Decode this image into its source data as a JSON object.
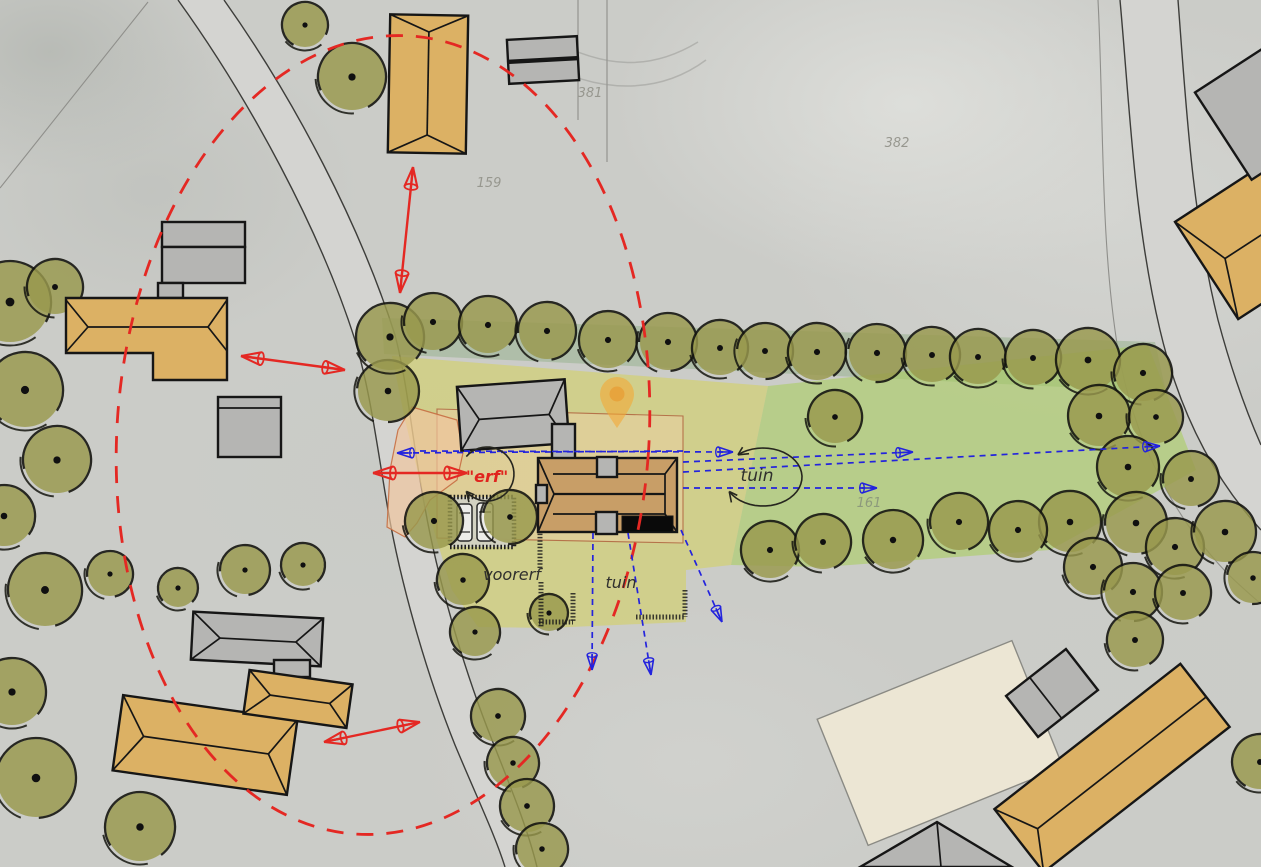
{
  "canvas": {
    "w": 1261,
    "h": 867
  },
  "colors": {
    "tan": "#dcb164",
    "gray": "#b5b5b3",
    "house": "#c89e67",
    "cream": "#ece6d4",
    "black": "#0a0a0a",
    "outline": "#161616",
    "red": "#e42823",
    "blue": "#2323dd",
    "sketch": "#26261f",
    "road_fill": "#d4d4d1",
    "road_edge": "#3d3d3a",
    "tree_fill": "#99994d",
    "tree_line": "#15150f",
    "strip": "rgba(148,176,138,0.5)",
    "green": "rgba(168,206,88,0.55)",
    "yellow": "rgba(213,210,80,0.5)",
    "plot_fill": "rgba(240,206,166,0.45)",
    "plot_edge": "#b5734a",
    "erf_fill": "rgba(240,198,158,0.68)",
    "erf_edge": "rgba(198,110,66,0.9)",
    "pin": "rgba(244,168,54,0.6)",
    "parcel_text": "#97978f"
  },
  "roads": [
    {
      "name": "road-west",
      "band": "M178,0 C250,100 320,230 355,340 C370,390 376,440 388,510 C400,580 425,670 455,745 C478,800 495,835 505,867 L537,867 C528,830 513,793 492,740 C462,665 437,575 425,508 C412,440 408,385 395,335 C360,225 295,100 224,0 Z",
      "edges": [
        "M178,0 C250,100 320,230 355,340 C370,390 376,440 388,510 C400,580 425,670 455,745 C478,800 495,835 505,867",
        "M224,0 C295,100 360,225 395,335 C408,385 412,440 425,508 C437,575 462,665 492,740 C513,793 528,830 537,867"
      ]
    },
    {
      "name": "road-east",
      "band": "M1120,0 C1130,110 1134,220 1160,330 C1180,415 1215,480 1261,530 L1261,445 C1250,420 1234,380 1218,320 C1192,215 1186,105 1178,0 Z",
      "edges": [
        "M1120,0 C1130,110 1134,220 1160,330 C1180,415 1215,480 1261,530",
        "M1178,0 C1186,105 1192,215 1218,320 C1234,380 1250,420 1261,445"
      ]
    }
  ],
  "thin_lines": [
    "M578,0 L578,120",
    "M607,0 L607,162",
    "M148,2 L0,188",
    "M1098,0 C1104,120 1100,240 1118,350 C1134,440 1172,515 1226,572 C1240,586 1252,596 1261,604"
  ],
  "photo_lines": [
    "M535,58 C598,96 660,94 706,60",
    "M548,38 C606,70 652,70 698,42"
  ],
  "zones": [
    {
      "name": "zone-hedge-strip",
      "d": "M382,318 L1155,342 L1166,392 L384,354 Z",
      "fill": "strip"
    },
    {
      "name": "zone-garden-green",
      "d": "M768,386 L1148,345 L1196,470 L1050,550 L823,567 L731,565 Z",
      "fill": "green"
    },
    {
      "name": "zone-yard-yellow",
      "d": "M392,356 L768,386 L731,565 L686,570 L686,622 L548,628 L478,627 L452,590 L424,498 L405,420 Z",
      "fill": "yellow"
    },
    {
      "name": "zone-plot-outline",
      "d": "M437,409 L683,416 L683,543 L437,538 Z",
      "fill": "plot_fill",
      "stroke": "plot_edge",
      "sw": 1.1
    },
    {
      "name": "zone-erf-salmon",
      "d": "M412,407 L457,420 L463,453 L457,480 L430,500 L417,523 L405,537 L387,527 L390,470 L398,430 Z",
      "fill": "erf_fill",
      "stroke": "erf_edge",
      "sw": 1.2
    }
  ],
  "ellipse": {
    "cx": 383,
    "cy": 435,
    "rx": 266,
    "ry": 400,
    "rot": 4,
    "dash": "17 13",
    "sw": 2.8
  },
  "trees": [
    [
      305,
      25,
      22
    ],
    [
      352,
      77,
      33
    ],
    [
      10,
      302,
      40
    ],
    [
      55,
      287,
      27
    ],
    [
      25,
      390,
      37
    ],
    [
      57,
      460,
      33
    ],
    [
      4,
      516,
      30
    ],
    [
      45,
      590,
      36
    ],
    [
      12,
      692,
      33
    ],
    [
      110,
      574,
      22
    ],
    [
      178,
      588,
      19
    ],
    [
      245,
      570,
      24
    ],
    [
      303,
      565,
      21
    ],
    [
      36,
      778,
      39
    ],
    [
      140,
      827,
      34
    ],
    [
      388,
      391,
      30
    ],
    [
      434,
      521,
      28
    ],
    [
      510,
      517,
      26
    ],
    [
      463,
      580,
      25
    ],
    [
      475,
      632,
      24
    ],
    [
      549,
      613,
      18
    ],
    [
      498,
      716,
      26
    ],
    [
      513,
      763,
      25
    ],
    [
      527,
      806,
      26
    ],
    [
      542,
      849,
      25
    ],
    [
      390,
      337,
      33
    ],
    [
      433,
      322,
      28
    ],
    [
      488,
      325,
      28
    ],
    [
      547,
      331,
      28
    ],
    [
      608,
      340,
      28
    ],
    [
      668,
      342,
      28
    ],
    [
      720,
      348,
      27
    ],
    [
      765,
      351,
      27
    ],
    [
      817,
      352,
      28
    ],
    [
      877,
      353,
      28
    ],
    [
      932,
      355,
      27
    ],
    [
      978,
      357,
      27
    ],
    [
      1033,
      358,
      27
    ],
    [
      1088,
      360,
      31
    ],
    [
      1143,
      373,
      28
    ],
    [
      1099,
      416,
      30
    ],
    [
      1156,
      417,
      26
    ],
    [
      1128,
      467,
      30
    ],
    [
      1191,
      479,
      27
    ],
    [
      1070,
      522,
      30
    ],
    [
      1136,
      523,
      30
    ],
    [
      1175,
      547,
      28
    ],
    [
      1225,
      532,
      30
    ],
    [
      1093,
      567,
      28
    ],
    [
      1133,
      592,
      28
    ],
    [
      1183,
      593,
      27
    ],
    [
      1253,
      578,
      25
    ],
    [
      1135,
      640,
      27
    ],
    [
      1260,
      762,
      27
    ],
    [
      835,
      417,
      26
    ],
    [
      770,
      550,
      28
    ],
    [
      823,
      542,
      27
    ],
    [
      893,
      540,
      29
    ],
    [
      959,
      522,
      28
    ],
    [
      1018,
      530,
      28
    ]
  ],
  "parking": {
    "x": 450,
    "y": 497,
    "w": 64,
    "h": 50
  },
  "cars": [
    {
      "x": 457,
      "y": 504,
      "w": 15,
      "h": 37
    },
    {
      "x": 477,
      "y": 503,
      "w": 16,
      "h": 38
    }
  ],
  "hatches": [
    [
      540,
      527,
      540,
      568
    ],
    [
      541,
      582,
      541,
      627
    ],
    [
      636,
      617,
      685,
      617
    ],
    [
      685,
      590,
      685,
      617
    ],
    [
      573,
      593,
      573,
      622
    ],
    [
      539,
      622,
      573,
      622
    ]
  ],
  "buildings": [
    {
      "name": "building-farm-north",
      "fill": "tan",
      "tx": 428,
      "ty": 84,
      "rot": 1,
      "shapes": [
        {
          "t": "rect",
          "x": -39,
          "y": -69,
          "w": 78,
          "h": 138
        },
        {
          "t": "line",
          "x1": 0,
          "y1": -52,
          "x2": 0,
          "y2": 51
        },
        {
          "t": "line",
          "x1": -39,
          "y1": -69,
          "x2": 0,
          "y2": -52
        },
        {
          "t": "line",
          "x1": 39,
          "y1": -69,
          "x2": 0,
          "y2": -52
        },
        {
          "t": "line",
          "x1": -39,
          "y1": 69,
          "x2": 0,
          "y2": 51
        },
        {
          "t": "line",
          "x1": 39,
          "y1": 69,
          "x2": 0,
          "y2": 51
        }
      ]
    },
    {
      "name": "shed-north-gray",
      "fill": "gray",
      "tx": 543,
      "ty": 60,
      "rot": -3,
      "shapes": [
        {
          "t": "rect",
          "x": -35,
          "y": -22,
          "w": 70,
          "h": 21
        },
        {
          "t": "rect",
          "x": -35,
          "y": 1,
          "w": 70,
          "h": 21
        }
      ]
    },
    {
      "name": "barn-west-gray",
      "fill": "gray",
      "shapes": [
        {
          "t": "rect",
          "x": 162,
          "y": 222,
          "w": 83,
          "h": 25
        },
        {
          "t": "rect",
          "x": 162,
          "y": 247,
          "w": 83,
          "h": 36
        },
        {
          "t": "rect",
          "x": 158,
          "y": 283,
          "w": 25,
          "h": 15
        }
      ]
    },
    {
      "name": "farmhouse-west",
      "fill": "tan",
      "shapes": [
        {
          "t": "poly",
          "pts": "66,298 227,298 227,380 153,380 153,353 66,353"
        },
        {
          "t": "line",
          "x1": 88,
          "y1": 327,
          "x2": 208,
          "y2": 327
        },
        {
          "t": "line",
          "x1": 66,
          "y1": 300,
          "x2": 88,
          "y2": 327
        },
        {
          "t": "line",
          "x1": 66,
          "y1": 352,
          "x2": 88,
          "y2": 327
        },
        {
          "t": "line",
          "x1": 227,
          "y1": 300,
          "x2": 208,
          "y2": 327
        },
        {
          "t": "line",
          "x1": 227,
          "y1": 351,
          "x2": 208,
          "y2": 327
        }
      ]
    },
    {
      "name": "shed-west-gray",
      "fill": "gray",
      "shapes": [
        {
          "t": "rect",
          "x": 218,
          "y": 397,
          "w": 63,
          "h": 60
        },
        {
          "t": "line",
          "x1": 218,
          "y1": 408,
          "x2": 281,
          "y2": 408
        }
      ]
    },
    {
      "name": "barn-site-gray",
      "fill": "gray",
      "tx": 513,
      "ty": 415,
      "rot": -4,
      "shapes": [
        {
          "t": "rect",
          "x": -54,
          "y": -32,
          "w": 108,
          "h": 64
        },
        {
          "t": "line",
          "x1": -34,
          "y1": 2,
          "x2": 36,
          "y2": 2
        },
        {
          "t": "line",
          "x1": -54,
          "y1": -32,
          "x2": -34,
          "y2": 2
        },
        {
          "t": "line",
          "x1": -54,
          "y1": 32,
          "x2": -34,
          "y2": 2
        },
        {
          "t": "line",
          "x1": 54,
          "y1": -32,
          "x2": 36,
          "y2": 2
        },
        {
          "t": "line",
          "x1": 54,
          "y1": 32,
          "x2": 36,
          "y2": 2
        }
      ]
    },
    {
      "name": "barn-annex-gray",
      "fill": "gray",
      "shapes": [
        {
          "t": "rect",
          "x": 552,
          "y": 424,
          "w": 23,
          "h": 40
        }
      ]
    },
    {
      "name": "main-house",
      "fill": "house",
      "shapes": [
        {
          "t": "rect",
          "x": 538,
          "y": 458,
          "w": 139,
          "h": 74
        },
        {
          "t": "line",
          "x1": 553,
          "y1": 474,
          "x2": 665,
          "y2": 474
        },
        {
          "t": "line",
          "x1": 553,
          "y1": 514,
          "x2": 665,
          "y2": 514
        },
        {
          "t": "line",
          "x1": 554,
          "y1": 494,
          "x2": 665,
          "y2": 494,
          "w": 2.2
        },
        {
          "t": "line",
          "x1": 538,
          "y1": 458,
          "x2": 554,
          "y2": 494
        },
        {
          "t": "line",
          "x1": 538,
          "y1": 532,
          "x2": 554,
          "y2": 494
        },
        {
          "t": "line",
          "x1": 665,
          "y1": 474,
          "x2": 665,
          "y2": 514
        },
        {
          "t": "line",
          "x1": 677,
          "y1": 458,
          "x2": 665,
          "y2": 474
        },
        {
          "t": "line",
          "x1": 677,
          "y1": 532,
          "x2": 665,
          "y2": 514
        },
        {
          "t": "rect",
          "x": 597,
          "y": 457,
          "w": 20,
          "h": 20,
          "fill": "gray"
        },
        {
          "t": "rect",
          "x": 596,
          "y": 512,
          "w": 21,
          "h": 22,
          "fill": "gray"
        },
        {
          "t": "rect",
          "x": 536,
          "y": 485,
          "w": 11,
          "h": 18,
          "fill": "gray"
        },
        {
          "t": "rect",
          "x": 622,
          "y": 516,
          "w": 51,
          "h": 16,
          "fill": "black",
          "sw": 1
        }
      ]
    },
    {
      "name": "building-cream",
      "fill": "cream",
      "stroke": "#8a8a84",
      "sw": 1.4,
      "tx": 940,
      "ty": 743,
      "rot": -22,
      "shapes": [
        {
          "t": "rect",
          "x": -105,
          "y": -68,
          "w": 210,
          "h": 136
        }
      ]
    },
    {
      "name": "shed-southeast-gray",
      "fill": "gray",
      "tx": 1052,
      "ty": 693,
      "rot": -38,
      "shapes": [
        {
          "t": "rect",
          "x": -38,
          "y": -26,
          "w": 76,
          "h": 52
        },
        {
          "t": "line",
          "x1": -8,
          "y1": -26,
          "x2": -8,
          "y2": 26
        }
      ]
    },
    {
      "name": "building-southeast-tan",
      "fill": "tan",
      "tx": 1112,
      "ty": 768,
      "rot": -38,
      "shapes": [
        {
          "t": "rect",
          "x": -118,
          "y": -40,
          "w": 236,
          "h": 80
        },
        {
          "t": "line",
          "x1": -96,
          "y1": 2,
          "x2": 118,
          "y2": 2
        },
        {
          "t": "line",
          "x1": -118,
          "y1": -40,
          "x2": -96,
          "y2": 2
        },
        {
          "t": "line",
          "x1": -118,
          "y1": 40,
          "x2": -96,
          "y2": 2
        }
      ]
    },
    {
      "name": "building-northeast-tan",
      "fill": "tan",
      "tx": 1272,
      "ty": 228,
      "rot": -33,
      "shapes": [
        {
          "t": "rect",
          "x": -78,
          "y": -58,
          "w": 156,
          "h": 116
        },
        {
          "t": "line",
          "x1": -56,
          "y1": 0,
          "x2": 78,
          "y2": 0
        },
        {
          "t": "line",
          "x1": -78,
          "y1": -58,
          "x2": -56,
          "y2": 0
        },
        {
          "t": "line",
          "x1": -78,
          "y1": 58,
          "x2": -56,
          "y2": 0
        }
      ]
    },
    {
      "name": "building-northeast-gray",
      "fill": "gray",
      "tx": 1282,
      "ty": 98,
      "rot": -33,
      "shapes": [
        {
          "t": "rect",
          "x": -70,
          "y": -52,
          "w": 140,
          "h": 104
        }
      ]
    },
    {
      "name": "building-south-gray",
      "fill": "gray",
      "shapes": [
        {
          "t": "poly",
          "pts": "860,867 937,822 1012,867"
        },
        {
          "t": "line",
          "x1": 937,
          "y1": 822,
          "x2": 941,
          "y2": 867
        }
      ]
    },
    {
      "name": "building-southwest-gray",
      "fill": "gray",
      "tx": 257,
      "ty": 639,
      "rot": 3,
      "shapes": [
        {
          "t": "rect",
          "x": -65,
          "y": -24,
          "w": 130,
          "h": 48
        },
        {
          "t": "line",
          "x1": -37,
          "y1": 1,
          "x2": 39,
          "y2": 1
        },
        {
          "t": "line",
          "x1": -65,
          "y1": -24,
          "x2": -37,
          "y2": 1
        },
        {
          "t": "line",
          "x1": -65,
          "y1": 24,
          "x2": -37,
          "y2": 1
        },
        {
          "t": "line",
          "x1": 65,
          "y1": -24,
          "x2": 39,
          "y2": 1
        },
        {
          "t": "line",
          "x1": 65,
          "y1": 24,
          "x2": 39,
          "y2": 1
        }
      ]
    },
    {
      "name": "connector-southwest",
      "fill": "gray",
      "shapes": [
        {
          "t": "rect",
          "x": 274,
          "y": 660,
          "w": 36,
          "h": 17
        }
      ]
    },
    {
      "name": "farmhouse-southwest",
      "fill": "tan",
      "tx": 205,
      "ty": 745,
      "rot": 8,
      "shapes": [
        {
          "t": "rect",
          "x": -88,
          "y": -38,
          "w": 176,
          "h": 76
        },
        {
          "t": "line",
          "x1": -62,
          "y1": 0,
          "x2": 64,
          "y2": 0
        },
        {
          "t": "line",
          "x1": -88,
          "y1": -38,
          "x2": -62,
          "y2": 0
        },
        {
          "t": "line",
          "x1": -88,
          "y1": 38,
          "x2": -62,
          "y2": 0
        },
        {
          "t": "line",
          "x1": 88,
          "y1": -38,
          "x2": 64,
          "y2": 0
        },
        {
          "t": "line",
          "x1": 88,
          "y1": 38,
          "x2": 64,
          "y2": 0
        }
      ]
    },
    {
      "name": "farmhouse-southwest-wing",
      "fill": "tan",
      "tx": 298,
      "ty": 699,
      "rot": 8,
      "shapes": [
        {
          "t": "rect",
          "x": -52,
          "y": -22,
          "w": 104,
          "h": 44
        },
        {
          "t": "line",
          "x1": -28,
          "y1": 0,
          "x2": 32,
          "y2": 0
        },
        {
          "t": "line",
          "x1": -52,
          "y1": -22,
          "x2": -28,
          "y2": 0
        },
        {
          "t": "line",
          "x1": -52,
          "y1": 22,
          "x2": -28,
          "y2": 0
        },
        {
          "t": "line",
          "x1": 52,
          "y1": -22,
          "x2": 32,
          "y2": 0
        },
        {
          "t": "line",
          "x1": 52,
          "y1": 22,
          "x2": 32,
          "y2": 0
        }
      ]
    }
  ],
  "pin": {
    "x": 617,
    "y": 428
  },
  "red_arrows": [
    [
      413,
      167,
      400,
      293
    ],
    [
      241,
      356,
      345,
      370
    ],
    [
      373,
      473,
      467,
      473
    ],
    [
      324,
      742,
      420,
      722
    ]
  ],
  "blue_arrows": [
    [
      683,
      451,
      397,
      453
    ],
    [
      420,
      451,
      733,
      452
    ],
    [
      683,
      472,
      1160,
      446
    ],
    [
      683,
      462,
      913,
      452
    ],
    [
      683,
      488,
      877,
      488
    ],
    [
      593,
      533,
      592,
      670
    ],
    [
      628,
      533,
      651,
      675
    ],
    [
      681,
      530,
      722,
      622
    ]
  ],
  "sketch_arcs": [
    {
      "name": "sketch-circle-erf",
      "cx": 487,
      "cy": 474,
      "rx": 27,
      "ry": 27,
      "a1": -140,
      "a2": 140,
      "heads": "end"
    },
    {
      "name": "sketch-circle-tuin",
      "cx": 763,
      "cy": 477,
      "rx": 39,
      "ry": 29,
      "a1": -130,
      "a2": 152,
      "heads": "both"
    }
  ],
  "labels": [
    {
      "name": "label-erf",
      "text": "\"erf\"",
      "x": 487,
      "y": 482,
      "color": "#e0241e",
      "size": 16,
      "weight": "700"
    },
    {
      "name": "label-tuin-east",
      "text": "tuin",
      "x": 757,
      "y": 481,
      "color": "#30302e",
      "size": 17
    },
    {
      "name": "label-tuin-south",
      "text": "tuin",
      "x": 621,
      "y": 588,
      "color": "#30302e",
      "size": 16
    },
    {
      "name": "label-voorerf",
      "text": "voorerf",
      "x": 512,
      "y": 580,
      "color": "#30302e",
      "size": 16
    },
    {
      "name": "parcel-159",
      "text": "159",
      "x": 489,
      "y": 187,
      "color": "#97978f",
      "size": 13
    },
    {
      "name": "parcel-381",
      "text": "381",
      "x": 590,
      "y": 97,
      "color": "#97978f",
      "size": 13
    },
    {
      "name": "parcel-382",
      "text": "382",
      "x": 897,
      "y": 147,
      "color": "#97978f",
      "size": 13
    },
    {
      "name": "parcel-161",
      "text": "161",
      "x": 869,
      "y": 507,
      "color": "#8d9a7c",
      "size": 13
    }
  ]
}
